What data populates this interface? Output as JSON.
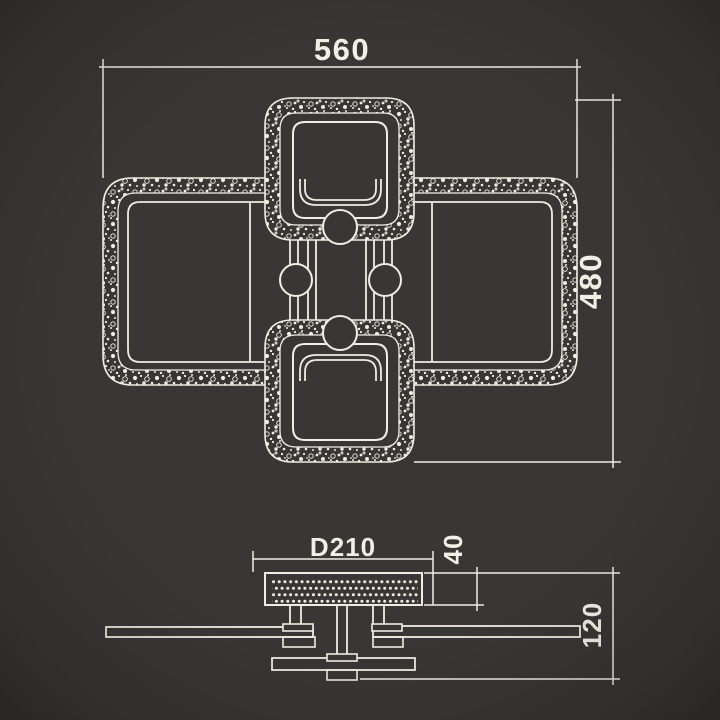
{
  "drawing": {
    "title": "ceiling-light-dimension-drawing",
    "colors": {
      "background": "#393735",
      "line": "#f0ede2",
      "text": "#f2efe4"
    },
    "plan_view": {
      "width_label": "560",
      "height_label": "480"
    },
    "side_view": {
      "canopy_diameter_label": "D210",
      "canopy_height_label": "40",
      "total_height_label": "120"
    }
  }
}
